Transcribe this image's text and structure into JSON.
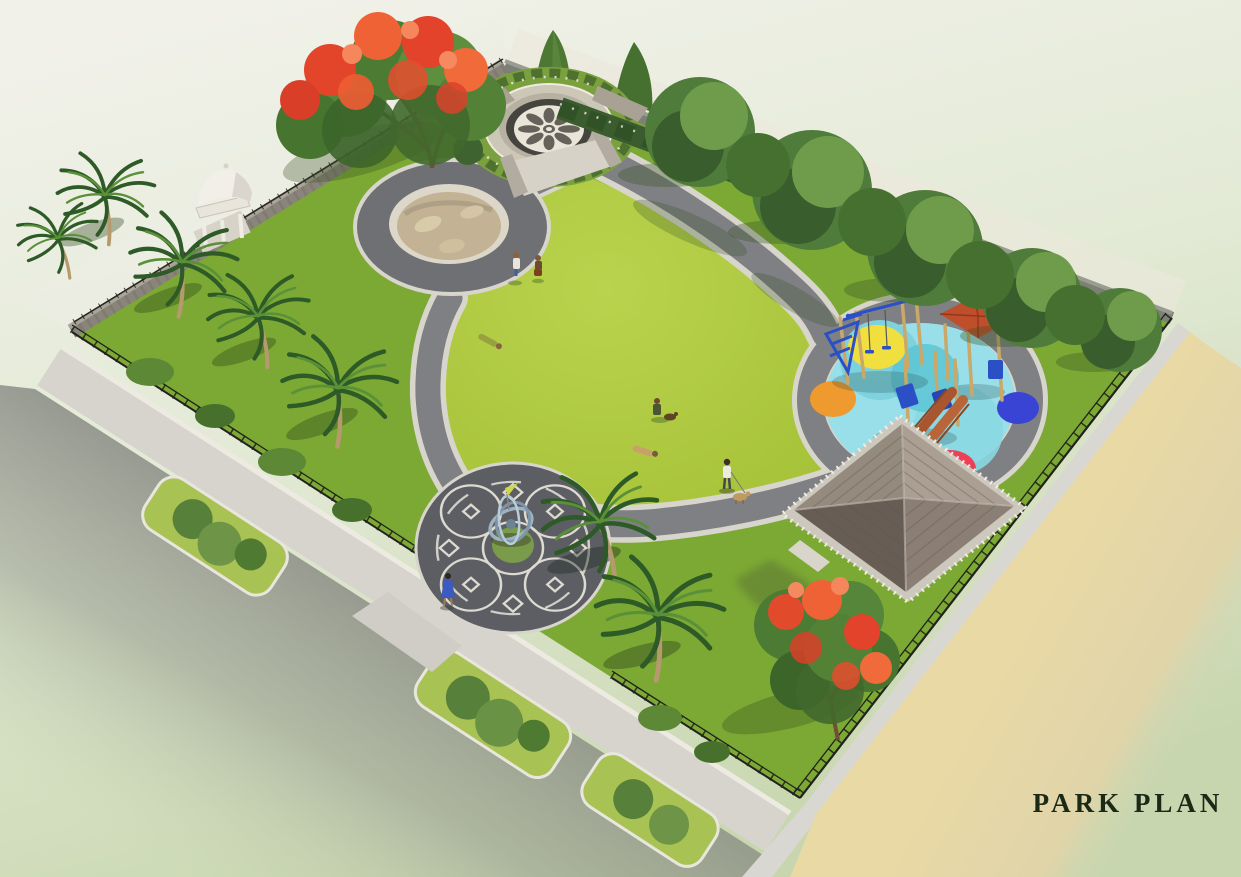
{
  "title": {
    "text": "PARK PLAN",
    "color": "#1b2917"
  },
  "features": [
    "mandala-plaza",
    "ornamental-pond",
    "central-lawn",
    "walking-path-loop",
    "sculpture-plaza",
    "childrens-playground",
    "gazebo",
    "dome-pavilion",
    "palm-trees",
    "flowering-trees",
    "tree-lined-boundary-wall",
    "perimeter-iron-fence",
    "outer-sidewalk",
    "sand-road",
    "park-visitors"
  ],
  "colors": {
    "canvas_top": "#f1f1e9",
    "canvas_mid": "#e3ead6",
    "canvas_bottom": "#c7d6ae",
    "lawn": "#abc63d",
    "lawn_light": "#bad34e",
    "verge_green": "#7ca934",
    "path_asphalt": "#7f8084",
    "path_curb": "#d8d5cc",
    "plaza_paving": "#5d5e63",
    "plaza_pattern": "#dcdad1",
    "pond_ring": "#6f7074",
    "pond_rim": "#ddd7c9",
    "pond_water": "#c3b294",
    "mandala_floor": "#e9e5d8",
    "mandala_pattern": "#56544d",
    "concrete": "#cdc7b8",
    "stone_wall": "#8a857b",
    "fence_iron": "#22221d",
    "sidewalk": "#d6d4cd",
    "road_shadow": "#7f817b",
    "sand_road": "#e9d9a5",
    "playground_surface": "#98dfe9",
    "playground_aqua": "#7ed2dd",
    "circle_yellow": "#f1df3f",
    "circle_orange": "#ee9a2e",
    "circle_blue": "#3a44d4",
    "circle_red": "#eb4055",
    "equipment_blue": "#2b50c5",
    "equipment_wood": "#c9a869",
    "slide_rust": "#a9562e",
    "canopy_red": "#bf4e2b",
    "gazebo_roof_light": "#ab9e92",
    "gazebo_roof_dark": "#675d55",
    "gazebo_plinth": "#ccc8bd",
    "foliage": "#4f7c3a",
    "foliage_dark": "#35582a",
    "foliage_light": "#6f9c4b",
    "hedge": "#3a5c2e",
    "palm_frond": "#2d5a27",
    "palm_frond_light": "#5a9038",
    "palm_trunk": "#b59a6d",
    "flower_red": "#e2452a",
    "flower_orange": "#ef6236",
    "pavilion_white": "#f1efe8"
  }
}
